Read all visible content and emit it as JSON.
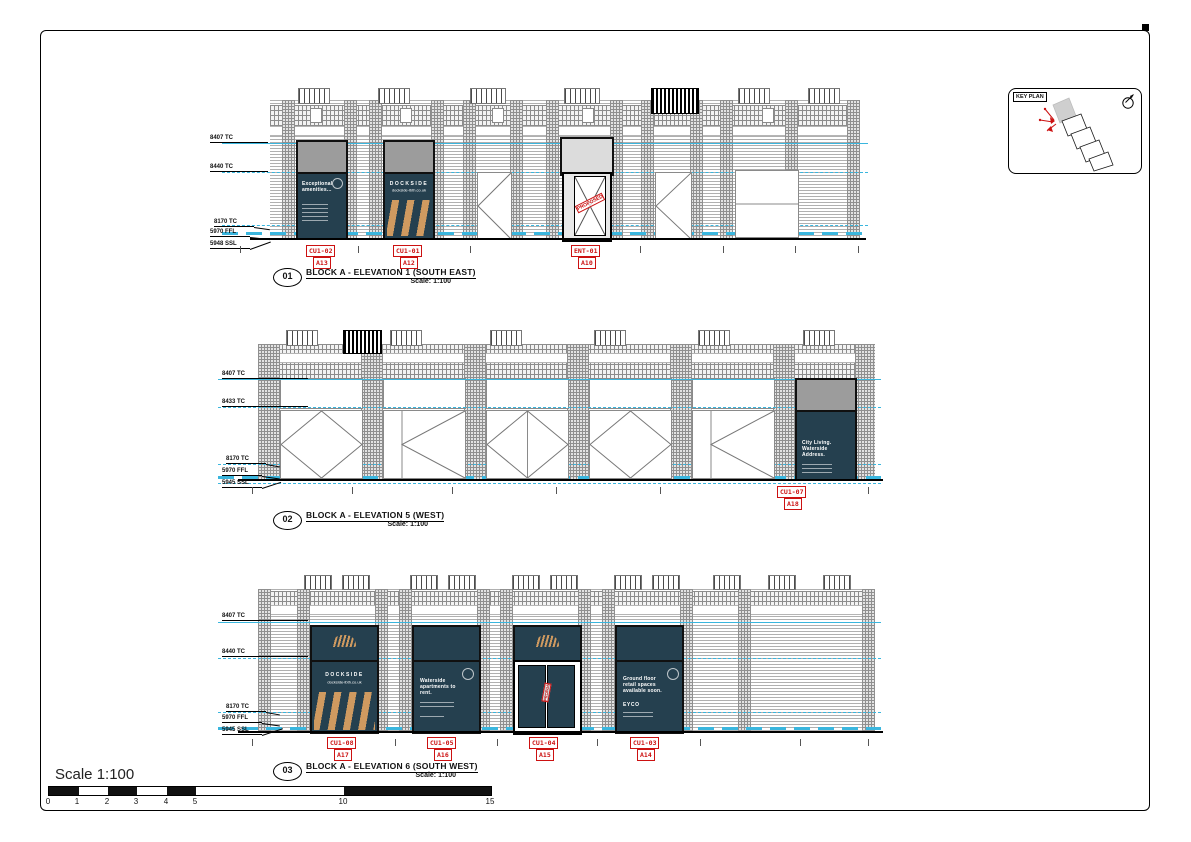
{
  "key_plan": {
    "label": "KEY PLAN"
  },
  "elevations": [
    {
      "number": "01",
      "title": "BLOCK A - ELEVATION 1 (SOUTH EAST)",
      "scale": "Scale: 1:100",
      "levels": [
        "8407 TC",
        "8440 TC",
        "8170 TC",
        "5970 FFL",
        "5948 SSL"
      ],
      "tags": [
        {
          "code": "CU1-02",
          "ref": "A13"
        },
        {
          "code": "CU1-01",
          "ref": "A12"
        },
        {
          "code": "ENT-01",
          "ref": "A10"
        }
      ]
    },
    {
      "number": "02",
      "title": "BLOCK A - ELEVATION 5 (WEST)",
      "scale": "Scale: 1:100",
      "levels": [
        "8407 TC",
        "8433 TC",
        "8170 TC",
        "5970 FFL",
        "5945 SSL"
      ],
      "tags": [
        {
          "code": "CU1-07",
          "ref": "A18"
        }
      ]
    },
    {
      "number": "03",
      "title": "BLOCK A - ELEVATION 6 (SOUTH WEST)",
      "scale": "Scale: 1:100",
      "levels": [
        "8407 TC",
        "8440 TC",
        "8170 TC",
        "5970 FFL",
        "5945 SSL"
      ],
      "tags": [
        {
          "code": "CU1-08",
          "ref": "A17"
        },
        {
          "code": "CU1-05",
          "ref": "A16"
        },
        {
          "code": "CU1-04",
          "ref": "A15"
        },
        {
          "code": "CU1-03",
          "ref": "A14"
        }
      ]
    }
  ],
  "signage": {
    "amenities": "Exceptional amenities...",
    "dockside": "DOCKSIDE",
    "dockside_url": "dockside-lbth.co.uk",
    "city_living": "City Living. Waterside Address.",
    "waterside": "Waterside apartments to rent.",
    "ground_floor": "Ground floor retail spaces available soon.",
    "brand": "EYCO",
    "stamp": "PROPOSED"
  },
  "scalebar": {
    "label": "Scale 1:100",
    "ticks": [
      "0",
      "1",
      "2",
      "3",
      "4",
      "5",
      "10",
      "15"
    ]
  },
  "colors": {
    "cyan": "#3ab6de",
    "panel": "#25404f",
    "red": "#cc1111",
    "orange": "#cf9a60"
  }
}
